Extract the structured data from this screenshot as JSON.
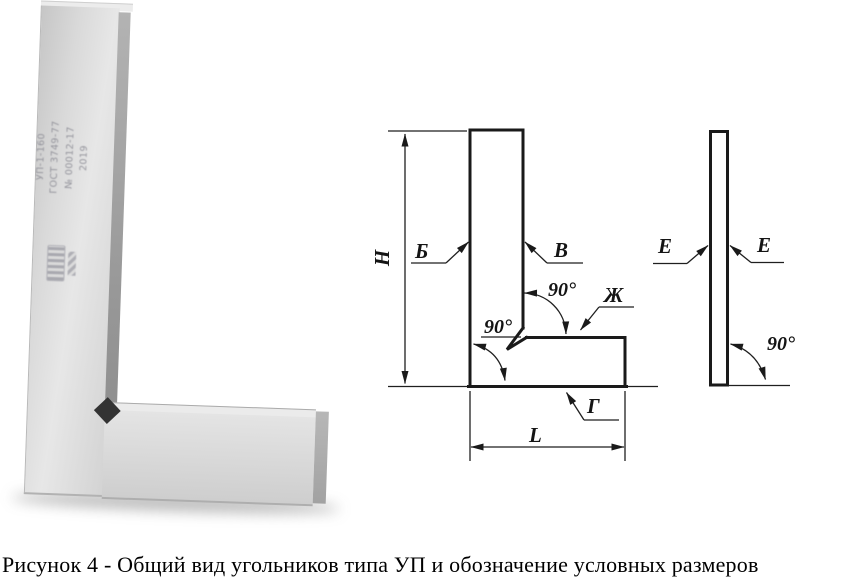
{
  "figure": {
    "caption": "Рисунок 4 - Общий вид угольников типа УП и обозначение условных размеров"
  },
  "photo": {
    "markings": {
      "model": "УП-1-160",
      "standard": "ГОСТ 3749-77",
      "serial": "№ 00012-17",
      "year": "2019"
    }
  },
  "front_view": {
    "labels": {
      "height": "Н",
      "outer_face": "Б",
      "inner_face": "В",
      "inner_angle": "90°",
      "base_working_face": "Ж",
      "outer_angle": "90°",
      "base_bottom_face": "Г",
      "length": "L"
    }
  },
  "side_view": {
    "labels": {
      "left_face": "Е",
      "right_face": "Е",
      "angle": "90°"
    }
  },
  "colors": {
    "line": "#1a1a1a",
    "metal_light": "#e7e7e7",
    "metal_mid": "#d3d3d3",
    "metal_dark": "#989898",
    "notch": "#333333",
    "background": "#ffffff"
  }
}
